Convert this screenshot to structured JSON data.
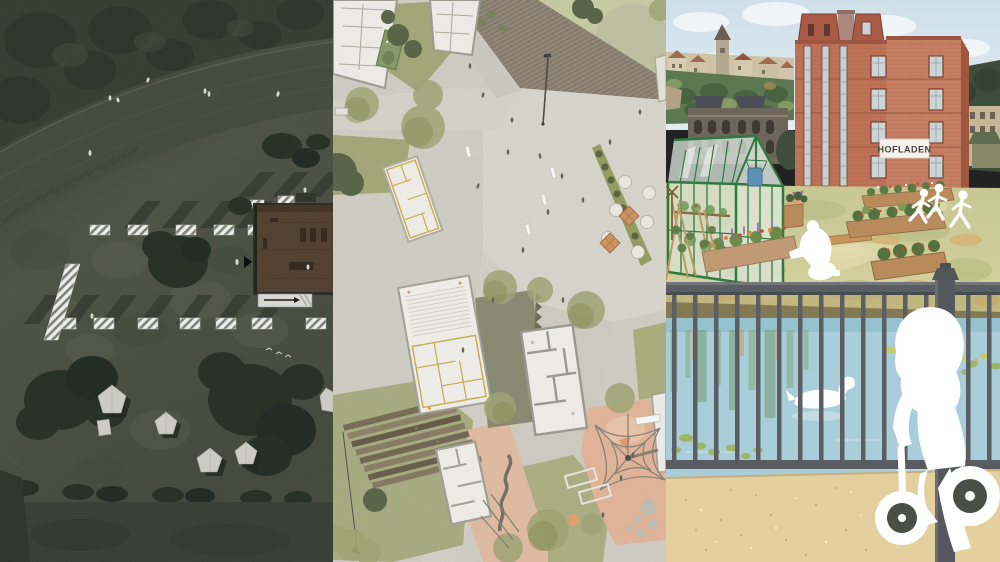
{
  "figure": {
    "kind": "architecture-visualization-triptych",
    "panels": {
      "left": {
        "label": "aerial site plan, dark rendering"
      },
      "middle": {
        "label": "urban site plan, light rendering"
      },
      "right": {
        "label": "community garden illustration"
      }
    }
  },
  "right_panel": {
    "building_sign": "HOFLADEN"
  },
  "colors": {
    "left_ground": "#66695c",
    "left_road": "#4d5245",
    "left_stripe": "#3c4137",
    "mid_base": "#d7d4ca",
    "mid_lawn": "#a9ad7e",
    "mid_playground": "#e8bb9f",
    "sky": "#cfe0ea",
    "brick": "#bd7156",
    "greenhouse_frame": "#2f7a3e",
    "pond": "#a9ced9",
    "sand": "#e4cf9f",
    "railing": "#5a5e62",
    "silhouette": "#ffffff"
  }
}
